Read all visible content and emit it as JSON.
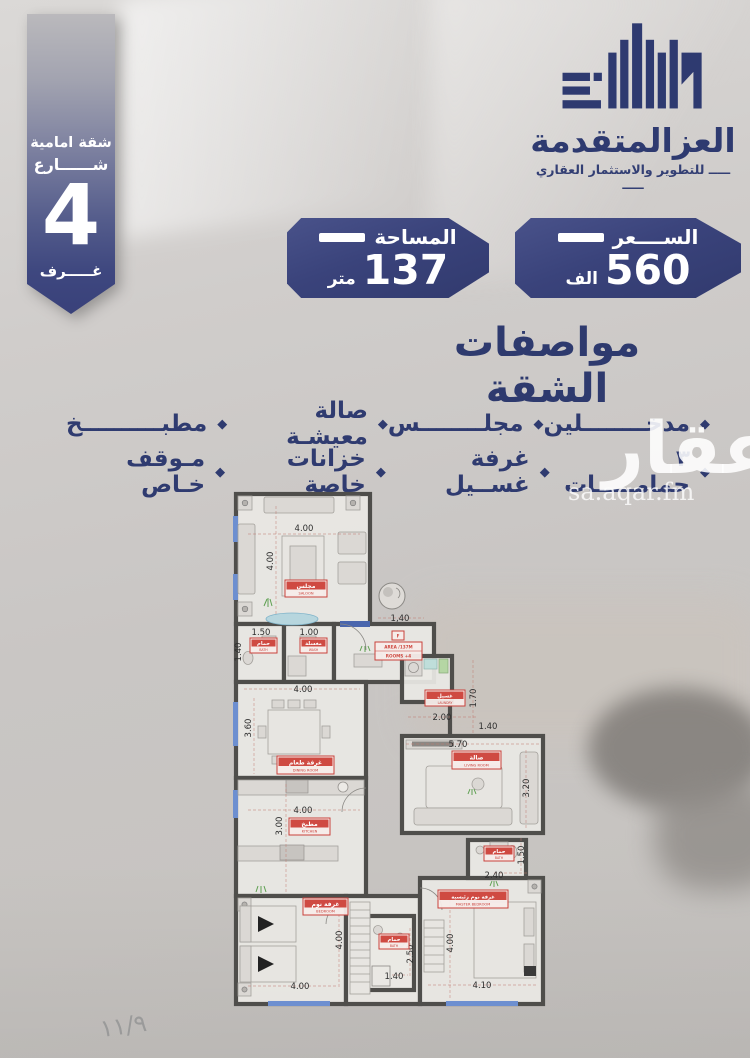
{
  "ribbon": {
    "line1": "شقة امامية",
    "line2": "شــــــارع",
    "number": "4",
    "line3": "غـــــرف"
  },
  "logo": {
    "name": "العزالمتقدمة",
    "tagline": "ـــــ للتطوير والاستثمار العقاري ـــــ"
  },
  "chips": {
    "area": {
      "label": "المساحة",
      "value": "137",
      "unit": "متر"
    },
    "price": {
      "label": "الســــعر",
      "value": "560",
      "unit": "الف"
    }
  },
  "specs": {
    "title": "مواصفات الشقة",
    "row1": [
      "مدخــــــــلين",
      "مجلــــــــس",
      "صالة معيشـة",
      "مطبــــــــــخ"
    ],
    "row2": [
      "٣ حمامـــــات",
      "غرفة غســيل",
      "خزانات خاصة",
      "مـوقف خـاص"
    ]
  },
  "watermark": {
    "brand": "عقار",
    "domain": "sa.aqar.fm"
  },
  "page_number": "١١/٩",
  "floorplan": {
    "labels": {
      "saloon": {
        "ar": "مجلس",
        "en": "SALOON"
      },
      "bath_top": {
        "ar": "حمام",
        "en": "BATH"
      },
      "wash": {
        "ar": "مغسلة",
        "en": "WASH"
      },
      "dining": {
        "ar": "غرفة طعام",
        "en": "DINING ROOM"
      },
      "laundry": {
        "ar": "غسيل",
        "en": "LAUNDRY"
      },
      "hall": {
        "ar": "صالة",
        "en": "LIVING ROOM"
      },
      "kitchen": {
        "ar": "مطبخ",
        "en": "KITCHEN"
      },
      "bath_master": {
        "ar": "حمام",
        "en": "BATH"
      },
      "bath_mid": {
        "ar": "حمام",
        "en": "BATH"
      },
      "bedroom": {
        "ar": "غرفة نوم",
        "en": "BEDROOM"
      },
      "master": {
        "ar": "غرفة نوم رئيسية",
        "en": "MASTER BEDROOM"
      }
    },
    "stamp": {
      "letter": "F",
      "line1": "AREA /137M",
      "line2": "4+ ROOMS"
    },
    "dims": {
      "saloon_w": "4.00",
      "saloon_h": "4.00",
      "bath_top_w": "1.50",
      "wash_w": "1.00",
      "side_left": "1.40",
      "entry": "1,40",
      "dining_w": "4.00",
      "dining_h": "3.60",
      "laundry_w": "2.00",
      "laundry_h": "1.70",
      "corridor": "1.40",
      "hall_w": "5.70",
      "hall_h": "3.20",
      "kitchen_w": "4.00",
      "kitchen_h": "3.00",
      "bath_master_w": "2.40",
      "bath_master_h": "1.50",
      "bath_mid_w": "1.40",
      "bath_mid_h": "2.50",
      "bedroom_w": "4.00",
      "bedroom_h": "4.00",
      "master_w": "4.10",
      "master_h": "4.00"
    }
  }
}
